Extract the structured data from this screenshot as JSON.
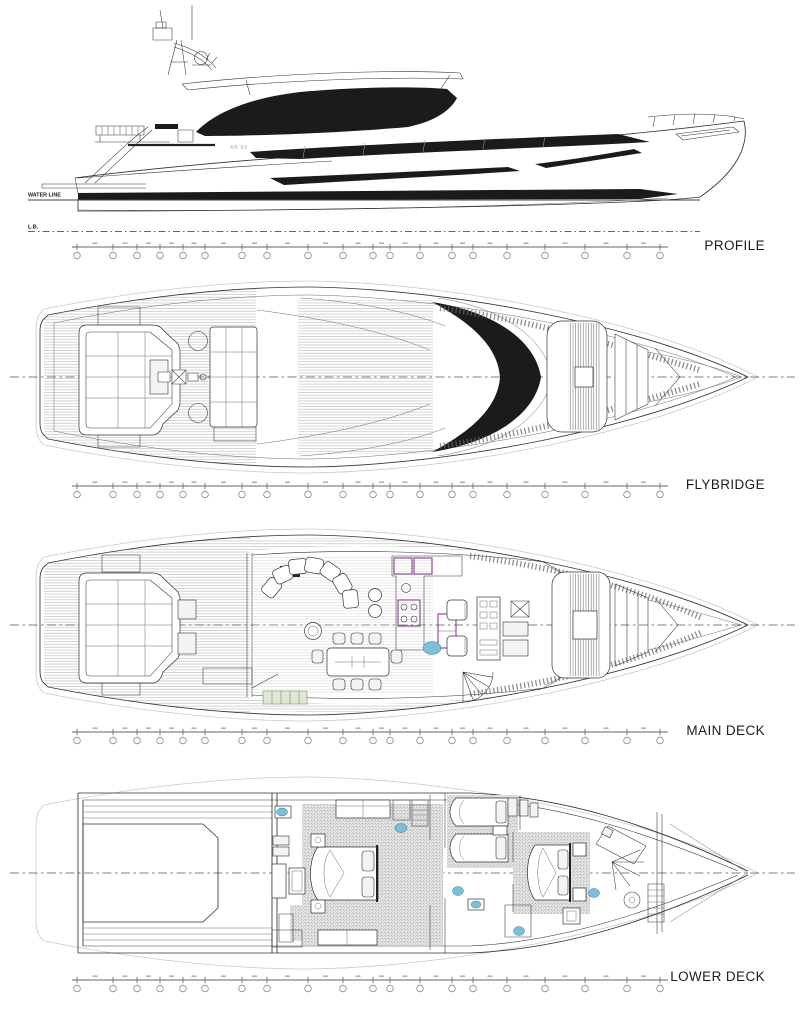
{
  "views": {
    "profile": {
      "label": "PROFILE"
    },
    "flybridge": {
      "label": "FLYBRIDGE"
    },
    "main_deck": {
      "label": "MAIN DECK"
    },
    "lower_deck": {
      "label": "LOWER DECK"
    }
  },
  "profile_annotations": {
    "waterline": "WATER LINE",
    "baseline": "L.B.",
    "hull_mark": "AB 80"
  },
  "colors": {
    "line": "#333333",
    "thin_line": "#6e6e6e",
    "ghost": "#c9c9c9",
    "glass": "#1b1b1b",
    "accent_purple": "#8a3d96",
    "accent_blue": "#7ac0d8",
    "accent_green": "#dfe8d4",
    "carpet_bg": "#e4e4e4",
    "carpet_dot": "#9a9a9a",
    "label": "#1c1c1c"
  },
  "stations": {
    "count": 20
  }
}
